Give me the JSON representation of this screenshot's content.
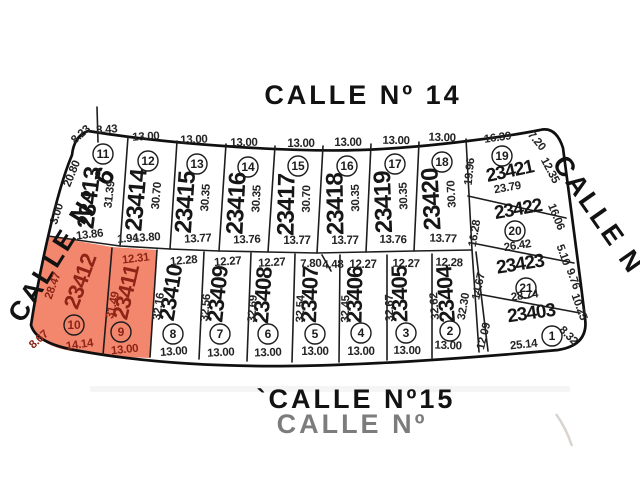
{
  "streets": {
    "top": "CALLE Nº 14",
    "bottom": "`CALLE Nº15",
    "left": "CALLE Nº 6",
    "right": "CALLE Nº 4",
    "ghost": "CALLE Nº"
  },
  "colors": {
    "highlight_fill": "#f2876e",
    "highlight_text": "#8d2415",
    "line": "#1d1d1d"
  },
  "lots": [
    {
      "parcel": "23413",
      "lot": "11",
      "front": "8.43",
      "front_curve": "8.23",
      "side_right": "31.39",
      "side_left": "20.80",
      "side_left2": "3.00",
      "back": "13.86",
      "back2": "1.94"
    },
    {
      "parcel": "23414",
      "lot": "12",
      "front": "13.00",
      "side": "30.70",
      "back": "13.80"
    },
    {
      "parcel": "23415",
      "lot": "13",
      "front": "13.00",
      "side": "30.35",
      "back": "13.77"
    },
    {
      "parcel": "23416",
      "lot": "14",
      "front": "13.00",
      "side": "30.35",
      "back": "13.76"
    },
    {
      "parcel": "23417",
      "lot": "15",
      "front": "13.00",
      "side": "30.70",
      "back": "13.77"
    },
    {
      "parcel": "23418",
      "lot": "16",
      "front": "13.00",
      "side": "30.35",
      "back": "13.77"
    },
    {
      "parcel": "23419",
      "lot": "17",
      "front": "13.00",
      "side": "30.35",
      "back": "13.76"
    },
    {
      "parcel": "23420",
      "lot": "18",
      "front": "13.00",
      "side": "30.70",
      "back": "13.77"
    },
    {
      "parcel": "23421",
      "lot": "19",
      "front": "16.39",
      "corner": "7.20",
      "side_right": "12.35",
      "side_left": "19.96",
      "back": "23.79"
    },
    {
      "parcel": "23422",
      "lot": "20",
      "side_left": "16.28",
      "side_right": "16.06",
      "back": "26.42"
    },
    {
      "parcel": "23423",
      "lot": "21",
      "side_left": "14.67",
      "side_right": "5.10",
      "side_right2": "9.76",
      "back": "28.74"
    },
    {
      "parcel": "23403",
      "lot": "1",
      "side_left": "12.09",
      "side_right": "10.25",
      "corner": "8.32",
      "back": "25.14"
    },
    {
      "parcel": "23404",
      "lot": "2",
      "front": "12.28",
      "side_left": "32.62",
      "side_right": "32.30",
      "back": "13.00"
    },
    {
      "parcel": "23405",
      "lot": "3",
      "front": "12.27",
      "side": "32.67",
      "back": "13.00"
    },
    {
      "parcel": "23406",
      "lot": "4",
      "front": "12.27",
      "side": "32.45",
      "back": "13.00"
    },
    {
      "parcel": "23407",
      "lot": "5",
      "front_a": "7.80",
      "front_b": "4.48",
      "side": "32.54",
      "back": "13.00"
    },
    {
      "parcel": "23408",
      "lot": "6",
      "front": "12.27",
      "side": "32.69",
      "back": "13.00"
    },
    {
      "parcel": "23409",
      "lot": "7",
      "front": "12.27",
      "side": "32.56",
      "back": "13.00"
    },
    {
      "parcel": "23410",
      "lot": "8",
      "front": "12.28",
      "side": "32.16",
      "back": "13.00"
    },
    {
      "parcel": "23411",
      "lot": "9",
      "front": "12.31",
      "side": "31.49",
      "back": "13.00",
      "highlighted": true
    },
    {
      "parcel": "23412",
      "lot": "10",
      "side_left": "28.47",
      "corner": "8.67",
      "back": "14.14",
      "highlighted": true
    }
  ]
}
